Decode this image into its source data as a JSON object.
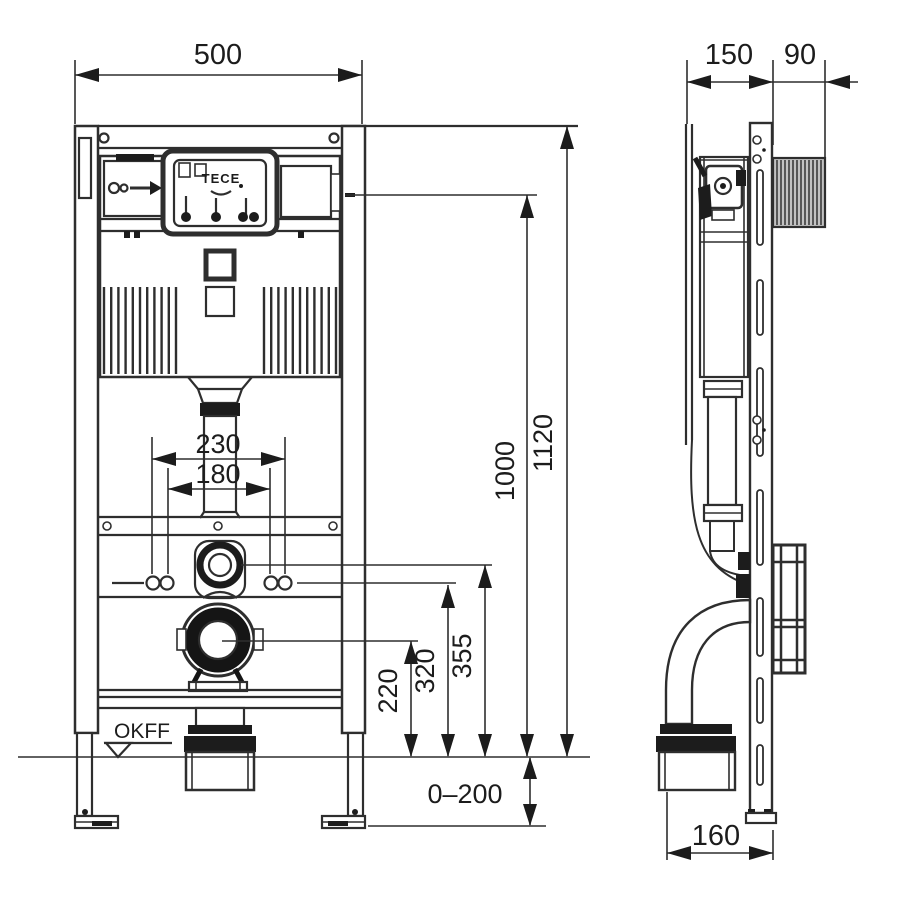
{
  "drawing_type": "installation frame technical drawing, front and side view",
  "front_view": {
    "brand": "TECE",
    "floor_label": "OKFF",
    "dims": {
      "width": "500",
      "fix_outer": "230",
      "fix_inner": "180",
      "total_height": "1120",
      "panel_height": "1000",
      "flush_bend_height": "355",
      "fixing_height": "320",
      "outlet_height": "220",
      "floor_adjust": "0–200"
    }
  },
  "side_view": {
    "dims": {
      "frame_depth": "150",
      "box_depth": "90",
      "outlet_offset": "160"
    }
  }
}
